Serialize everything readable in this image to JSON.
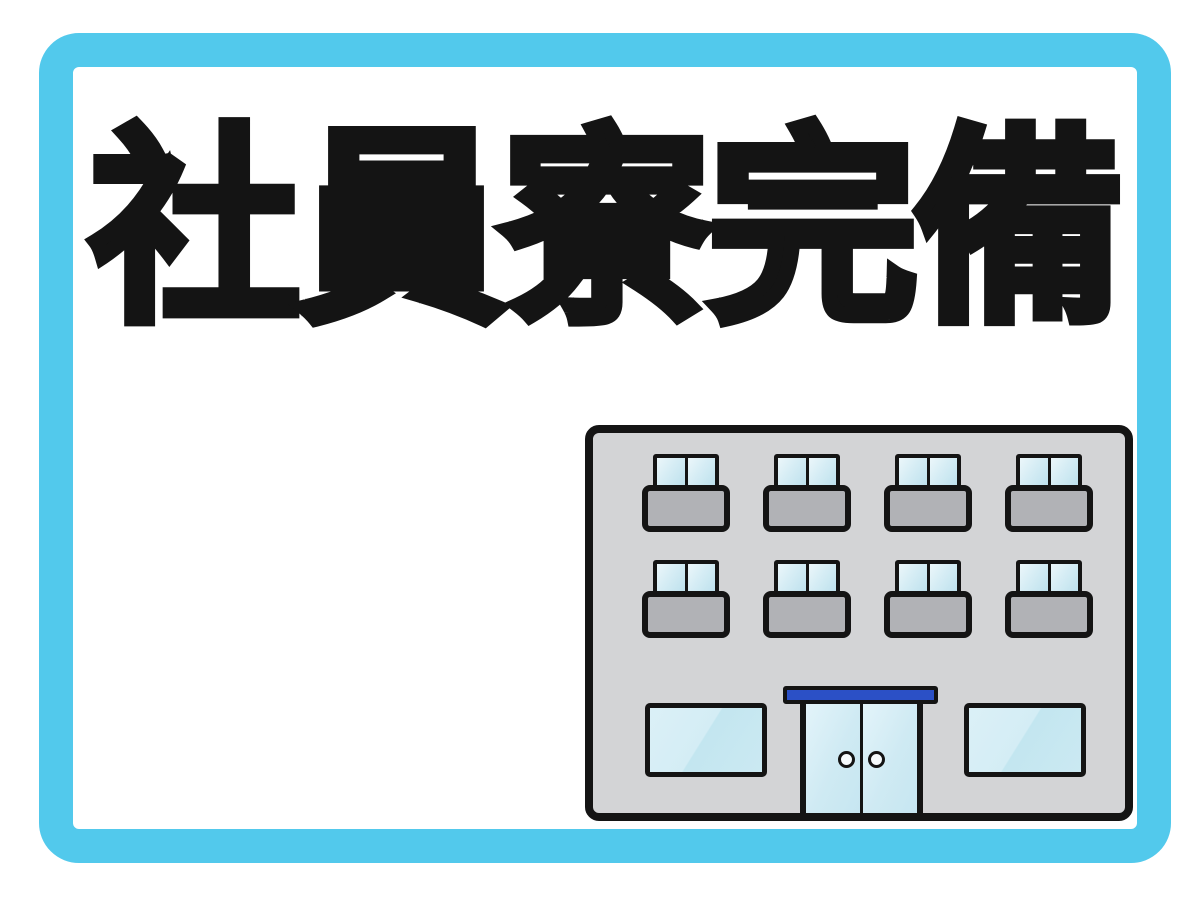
{
  "headline": {
    "text": "社員寮完備",
    "color": "#141414"
  },
  "frame": {
    "border_color": "#52c9ec",
    "background_color": "#ffffff"
  },
  "building": {
    "floors": {
      "upper_window_rows": 2,
      "windows_per_row": 4
    },
    "entrance": {
      "door_panes": 2,
      "door_handles": 2,
      "awning_color": "#2b50c6"
    },
    "ground_floor_windows": 2,
    "colors": {
      "body": "#d3d4d6",
      "balcony": "#b1b2b6",
      "outline": "#141414",
      "glass": "#cfeaf3",
      "glass_highlight": "#e3f4fa"
    }
  }
}
